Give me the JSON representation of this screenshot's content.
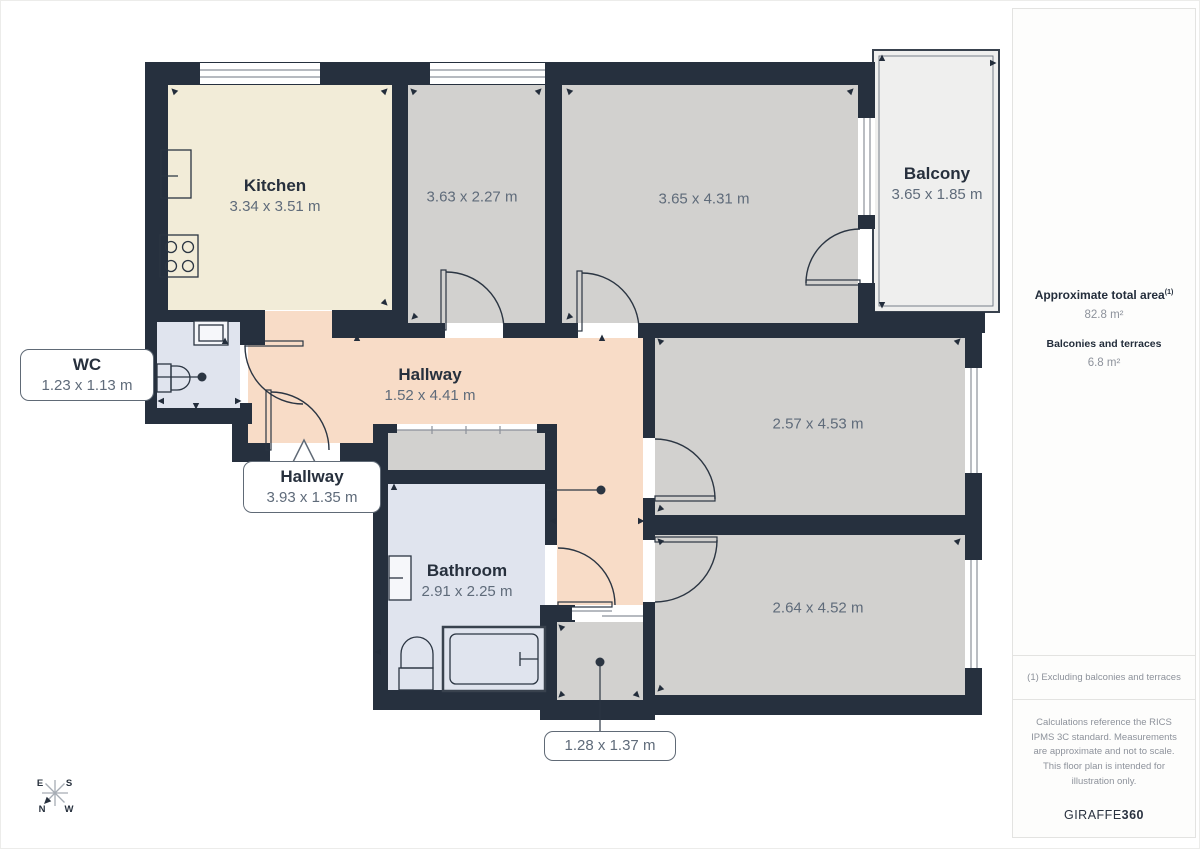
{
  "plan": {
    "rooms": {
      "kitchen": {
        "name": "Kitchen",
        "dims": "3.34 x 3.51 m"
      },
      "room_a": {
        "dims": "3.63 x 2.27 m"
      },
      "room_b": {
        "dims": "3.65 x 4.31 m"
      },
      "balcony": {
        "name": "Balcony",
        "dims": "3.65 x 1.85 m"
      },
      "wc": {
        "name": "WC",
        "dims": "1.23 x 1.13 m"
      },
      "hallway_main": {
        "name": "Hallway",
        "dims": "1.52 x 4.41 m"
      },
      "hallway_lower": {
        "name": "Hallway",
        "dims": "3.93 x 1.35 m"
      },
      "bathroom": {
        "name": "Bathroom",
        "dims": "2.91 x 2.25 m"
      },
      "room_c": {
        "dims": "2.57 x 4.53 m"
      },
      "room_d": {
        "dims": "2.64 x 4.52 m"
      },
      "storage": {
        "dims": "1.28 x 1.37 m"
      }
    },
    "compass": {
      "n": "N",
      "e": "E",
      "s": "S",
      "w": "W"
    }
  },
  "sidebar": {
    "total_area_label": "Approximate total area",
    "total_area_superscript": "(1)",
    "total_area_value": "82.8 m²",
    "balconies_label": "Balconies and terraces",
    "balconies_value": "6.8 m²",
    "footnote": "(1) Excluding balconies and terraces",
    "disclaimer": "Calculations reference the RICS IPMS 3C standard. Measurements are approximate and not to scale. This floor plan is intended for illustration only.",
    "brand_name": "GIRAFFE",
    "brand_suffix": "360"
  },
  "colors": {
    "wall": "#26303e",
    "room_gray": "#d2d1cf",
    "kitchen_cream": "#f2ecd8",
    "hallway_salmon": "#f8dcc7",
    "bath_blue": "#e0e4ee",
    "balcony_white": "#efefee",
    "label_dark": "#27303d",
    "dims_gray": "#5f6b7a"
  }
}
